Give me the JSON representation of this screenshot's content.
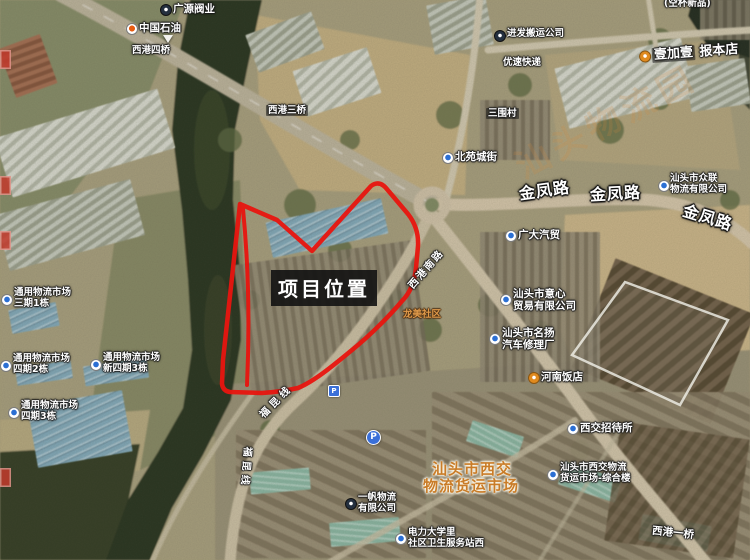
{
  "annotation": {
    "project_label": "项目位置"
  },
  "colors": {
    "boundary_red": "#e8150f",
    "road_label_white": "#ffffff",
    "market_orange": "#c97c28"
  },
  "watermark": {
    "text": "汕头物流园"
  },
  "labels": {
    "guangyuan": "广源阀业",
    "petrochina": "中国石油",
    "xigang4": "西港四桥",
    "xigang3": "西港三桥",
    "jinfa": "进发搬运公司",
    "yousu": "优速快递",
    "kongbei": "(空杯新品)",
    "baoben": {
      "brand": "壹加壹",
      "name": "报本店"
    },
    "sanwei": "三围村",
    "beiyuan": "北苑城街",
    "jinfeng1": "金凤路",
    "jinfeng2": "金凤路",
    "jinfeng3": "金凤路",
    "zhonglian": {
      "line1": "汕头市众联",
      "line2": "物流有限公司"
    },
    "guangda": "广大汽贸",
    "yixin": {
      "line1": "汕头市意心",
      "line2": "贸易有限公司"
    },
    "mingyang": {
      "line1": "汕头市名扬",
      "line2": "汽车修理厂"
    },
    "henan": "河南饭店",
    "xijiao_inn": "西交招待所",
    "xijiao_complex": {
      "line1": "汕头市西交物流",
      "line2": "货运市场-综合楼"
    },
    "xijiao_market": {
      "line1": "汕头市西交",
      "line2": "物流货运市场"
    },
    "xigang1": "西港一桥",
    "yifan": {
      "line1": "一帆物流",
      "line2": "有限公司"
    },
    "clinic": {
      "line1": "电力大学里",
      "line2": "社区卫生服务站西"
    },
    "tongyong1": {
      "line1": "通用物流市场",
      "line2": "三期1栋"
    },
    "tongyong2": {
      "line1": "通用物流市场",
      "line2": "四期2栋"
    },
    "tongyong3": {
      "line1": "通用物流市场",
      "line2": "新四期3栋"
    },
    "tongyong4": {
      "line1": "通用物流市场",
      "line2": "四期3栋"
    },
    "fukun1": "福昆线",
    "fukun2": "福昆线",
    "xigang_south": "西港南路",
    "longmei": "龙美社区",
    "parking": "P"
  }
}
